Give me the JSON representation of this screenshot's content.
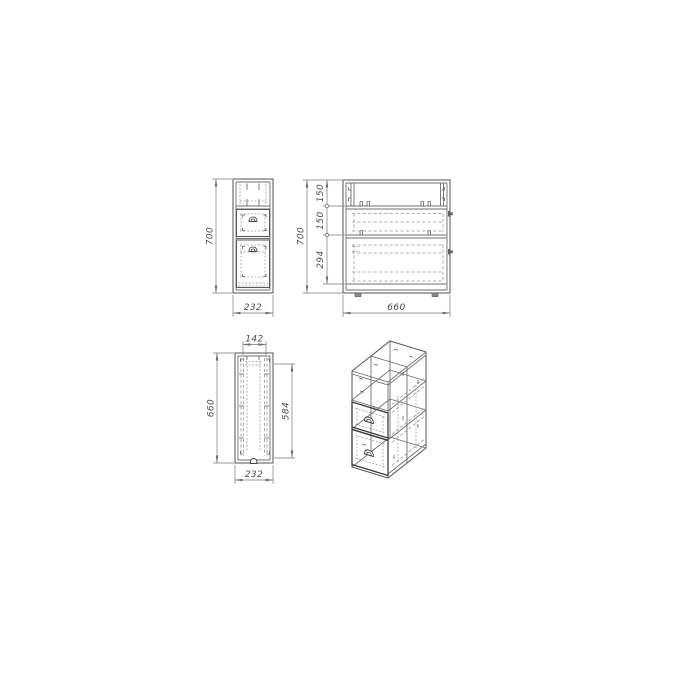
{
  "colors": {
    "background": "#ffffff",
    "structure_line": "#6f6f6f",
    "hidden_line": "#979797",
    "accent_line": "#3e3e3e",
    "dimension_line": "#7a7a7a",
    "dimension_text": "#4a4a4a"
  },
  "views": {
    "front": {
      "dims": {
        "height": "700",
        "width": "232"
      }
    },
    "side": {
      "dims": {
        "height": "700",
        "segment_top": "150",
        "segment_middle": "150",
        "segment_bottom": "294",
        "depth": "660"
      }
    },
    "plan": {
      "dims": {
        "inner_width": "142",
        "depth": "660",
        "inner_depth": "584",
        "width": "232"
      }
    }
  }
}
